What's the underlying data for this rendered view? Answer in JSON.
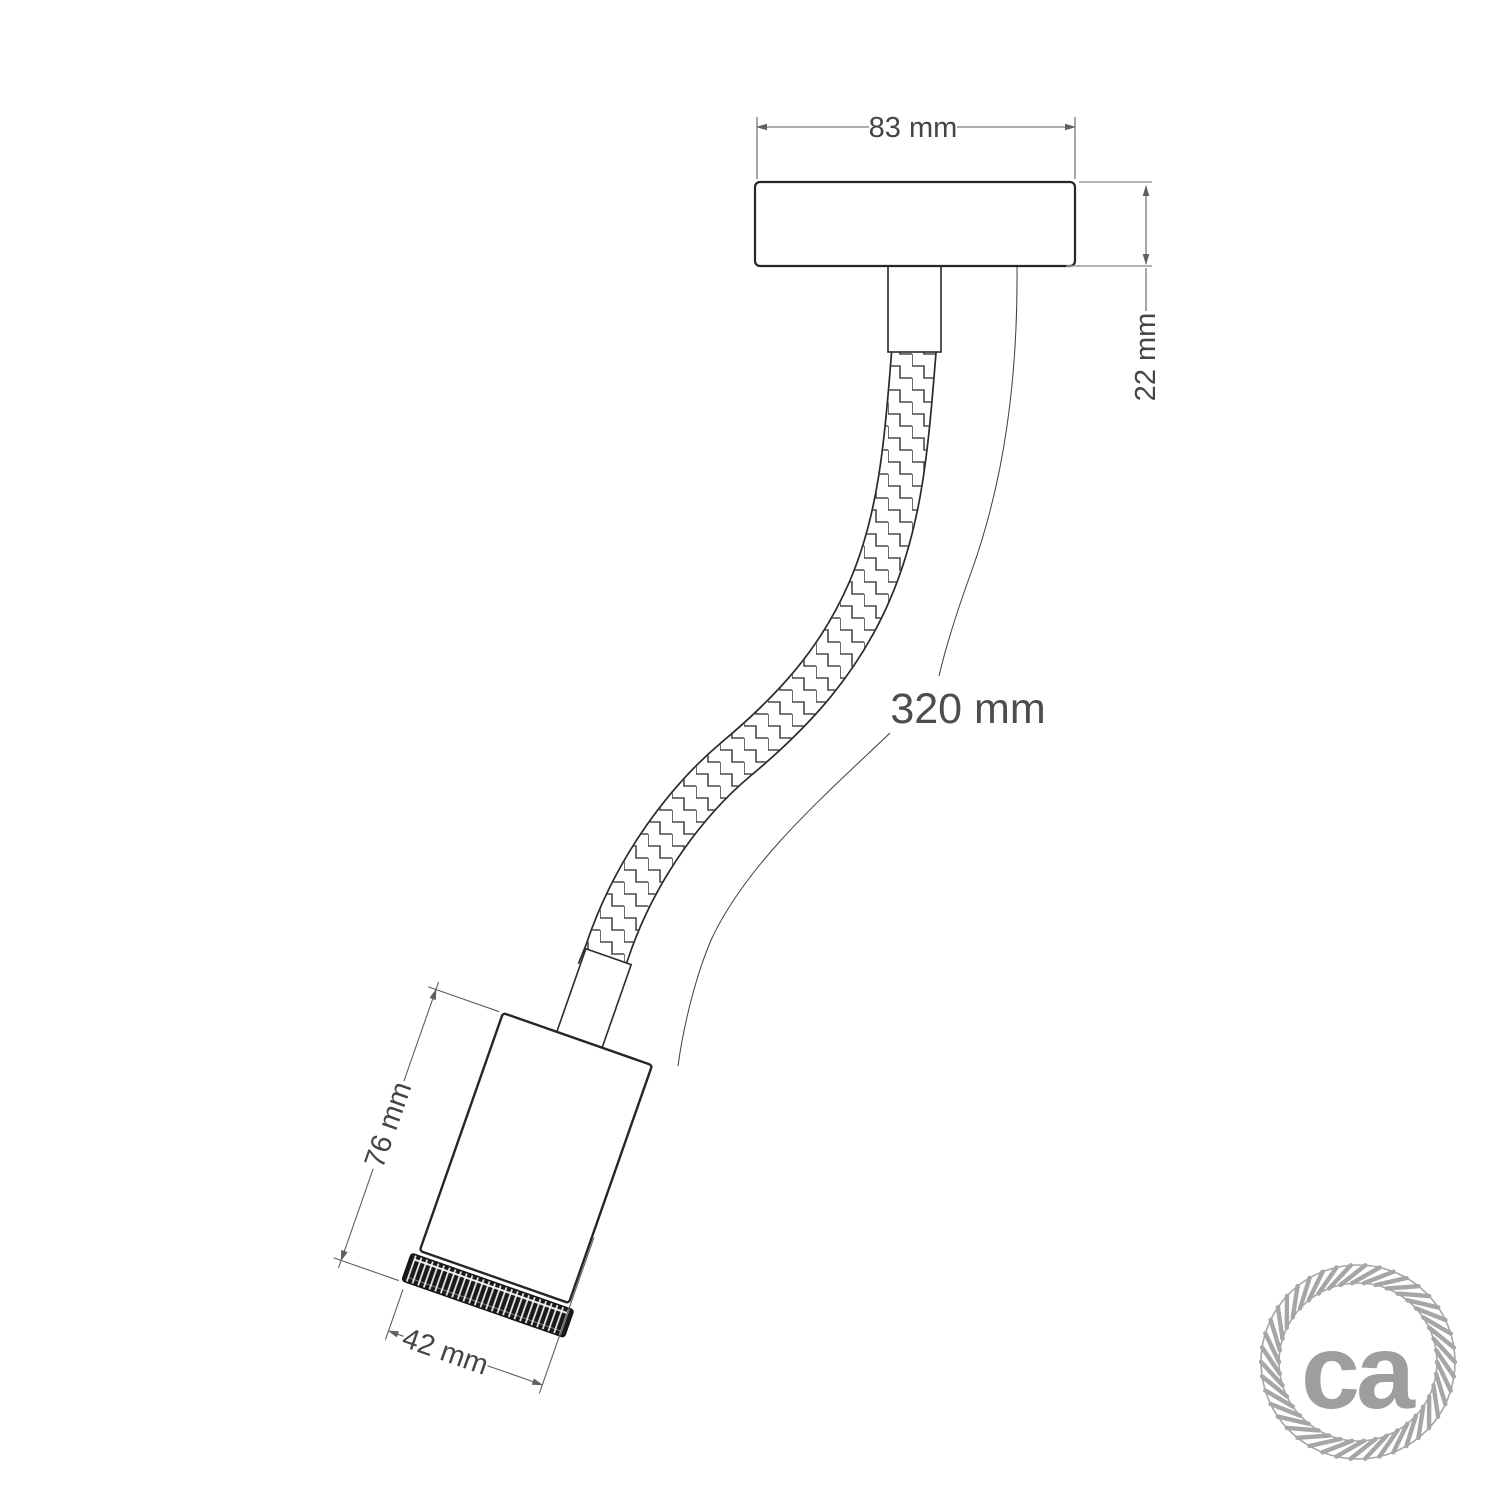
{
  "dimensions": {
    "canopy_width": "83 mm",
    "canopy_height": "22 mm",
    "flex_length": "320 mm",
    "holder_height": "76 mm",
    "holder_diameter": "42 mm"
  },
  "logo": {
    "text": "ca",
    "text_color": "#9e9e9e",
    "ring_color": "#a6a6a6",
    "tick_count": 42
  },
  "colors": {
    "background": "#ffffff",
    "outline": "#262626",
    "dimension_line": "#5f5f5f",
    "dimension_text": "#454545",
    "braid_weave": "#4a4a4a",
    "knurl_dark": "#1a1a1a"
  }
}
